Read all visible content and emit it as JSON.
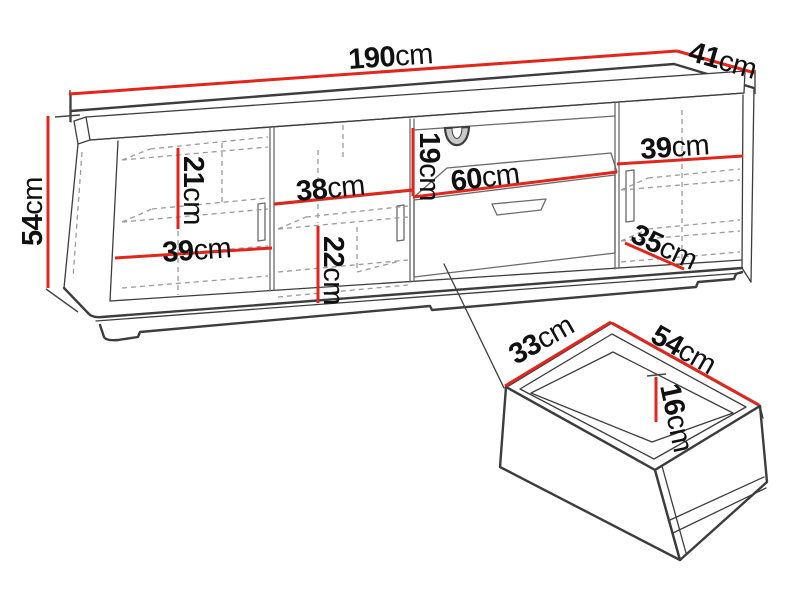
{
  "page": {
    "background": "#ffffff",
    "description": "TV stand dimension diagram with drawer detail"
  },
  "colors": {
    "dimension_red": "#e2261b",
    "outline_dark": "#3d3d3d",
    "line_mid": "#6a6a6a",
    "hidden_dashed": "#9b9b9b",
    "label_text": "#101010"
  },
  "labels": {
    "overall_width": {
      "value": "190",
      "unit": "cm"
    },
    "overall_depth": {
      "value": "41",
      "unit": "cm"
    },
    "overall_height": {
      "value": "54",
      "unit": "cm"
    },
    "left_upper_height": {
      "value": "21",
      "unit": "cm"
    },
    "middle_width": {
      "value": "38",
      "unit": "cm"
    },
    "left_width": {
      "value": "39",
      "unit": "cm"
    },
    "niche_height": {
      "value": "19",
      "unit": "cm"
    },
    "niche_width": {
      "value": "60",
      "unit": "cm"
    },
    "right_width": {
      "value": "39",
      "unit": "cm"
    },
    "middle_lower_height": {
      "value": "22",
      "unit": "cm"
    },
    "right_depth": {
      "value": "35",
      "unit": "cm"
    },
    "drawer_depth": {
      "value": "33",
      "unit": "cm"
    },
    "drawer_width": {
      "value": "54",
      "unit": "cm"
    },
    "drawer_inner_height": {
      "value": "16",
      "unit": "cm"
    }
  }
}
